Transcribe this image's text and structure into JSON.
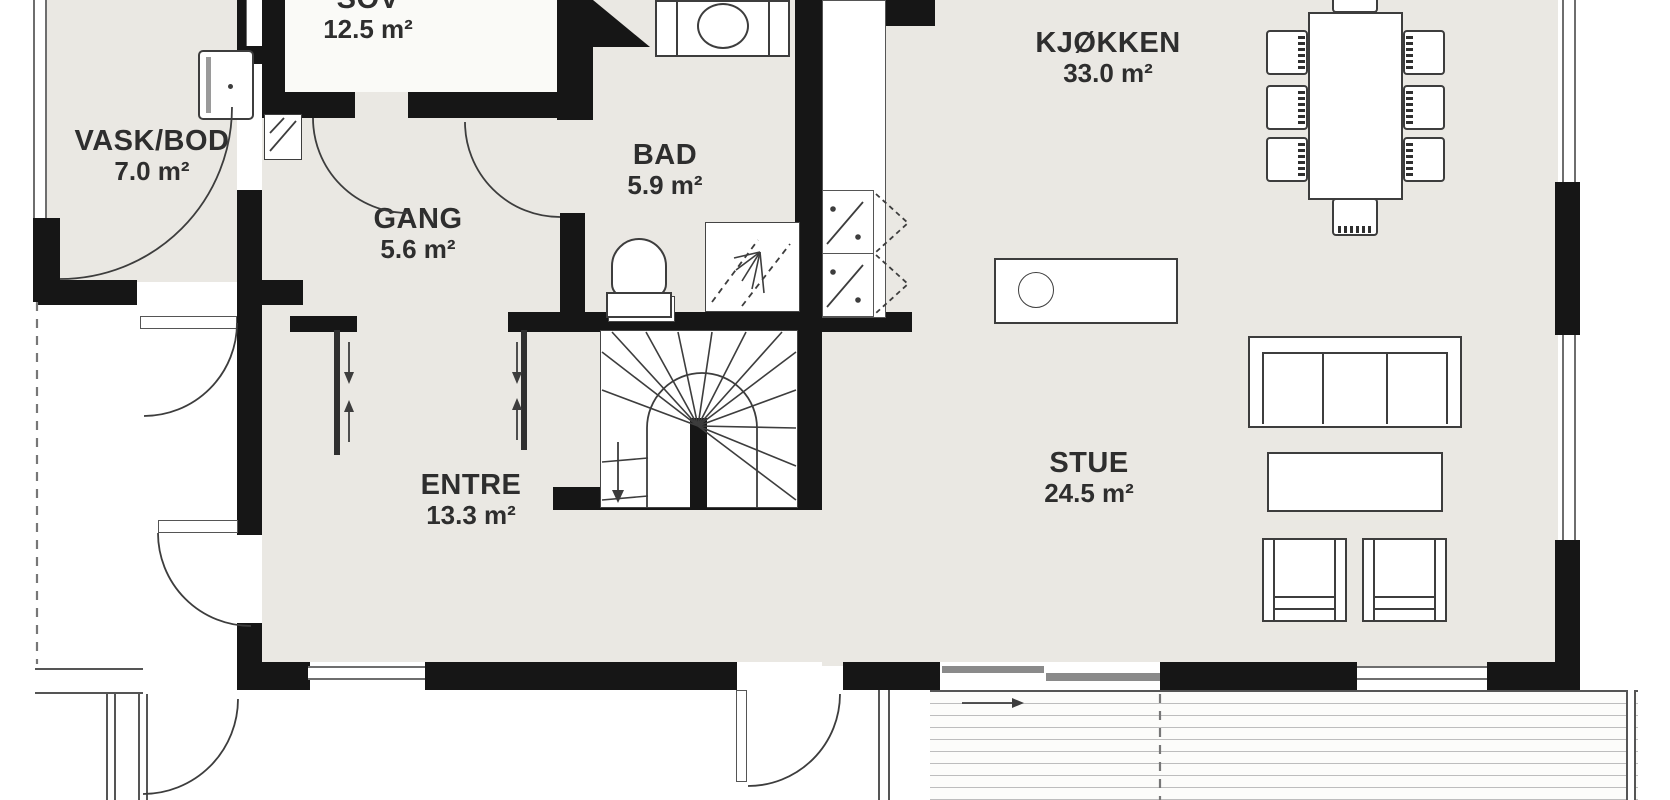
{
  "plan": {
    "title": "First floor plan",
    "rooms": [
      {
        "id": "sov",
        "name": "SOV",
        "area": "12.5 m²"
      },
      {
        "id": "vask-bod",
        "name": "VASK/BOD",
        "area": "7.0 m²"
      },
      {
        "id": "gang",
        "name": "GANG",
        "area": "5.6 m²"
      },
      {
        "id": "bad",
        "name": "BAD",
        "area": "5.9 m²"
      },
      {
        "id": "kjokken",
        "name": "KJØKKEN",
        "area": "33.0 m²"
      },
      {
        "id": "entre",
        "name": "ENTRE",
        "area": "13.3 m²"
      },
      {
        "id": "stue",
        "name": "STUE",
        "area": "24.5 m²"
      }
    ],
    "colors": {
      "wall": "#161616",
      "room_fill": "#EAE8E3",
      "sov_fill": "#FAFAF7",
      "stroke": "#3d3d3d",
      "window_frame": "#6e6e6e",
      "deck_plank": "#bdbdbd"
    },
    "fixtures": [
      "washing-machine",
      "water-heater",
      "vanity-sink",
      "toilet",
      "shower",
      "staircase-winder",
      "cooktop",
      "dishwasher",
      "kitchen-island-sink",
      "dining-table",
      "dining-chair",
      "sofa",
      "coffee-table",
      "armchair",
      "sliding-door",
      "hinged-door",
      "window",
      "terrace-deck",
      "entry-porch"
    ]
  }
}
